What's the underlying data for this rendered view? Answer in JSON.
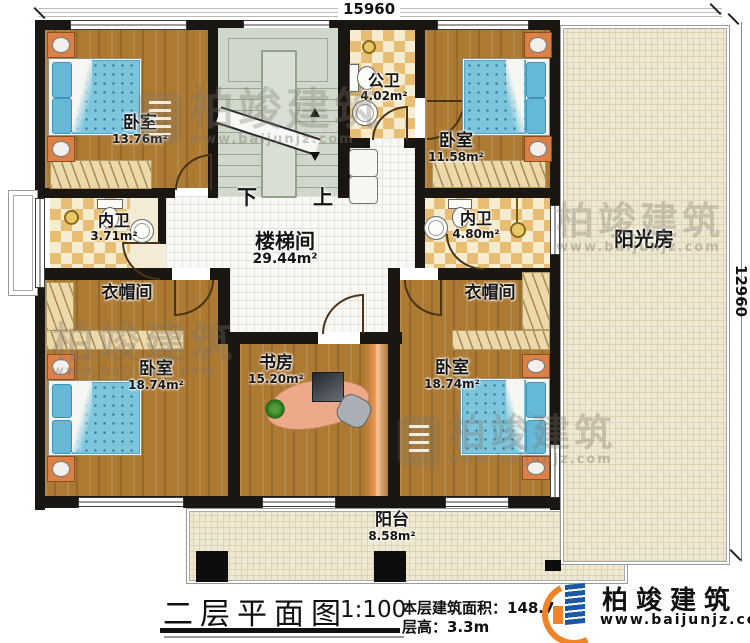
{
  "dimensions": {
    "top": "15960",
    "right": "12960"
  },
  "stairs": {
    "down_label": "下",
    "up_label": "上"
  },
  "rooms": {
    "bedroom_tl": {
      "name": "卧室",
      "area": "13.76m²"
    },
    "public_bath": {
      "name": "公卫",
      "area": "4.02m²"
    },
    "bedroom_tr": {
      "name": "卧室",
      "area": "11.58m²"
    },
    "bath_left": {
      "name": "内卫",
      "area": "3.71m²"
    },
    "stair_hall": {
      "name": "楼梯间",
      "area": "29.44m²"
    },
    "bath_right": {
      "name": "内卫",
      "area": "4.80m²"
    },
    "sunroom": {
      "name": "阳光房",
      "area": ""
    },
    "cloak_left": {
      "name": "衣帽间",
      "area": ""
    },
    "cloak_right": {
      "name": "衣帽间",
      "area": ""
    },
    "bedroom_bl": {
      "name": "卧室",
      "area": "18.74m²"
    },
    "study": {
      "name": "书房",
      "area": "15.20m²"
    },
    "bedroom_br": {
      "name": "卧室",
      "area": "18.74m²"
    },
    "balcony": {
      "name": "阳台",
      "area": "8.58m²"
    }
  },
  "title_block": {
    "title": "二层平面图",
    "scale": "1:100",
    "area_text": "本层建筑面积：148.7",
    "height_text": "层高：3.3m"
  },
  "logo": {
    "name": "柏竣建筑",
    "url": "www.baijunjz.com"
  },
  "watermark": {
    "text": "柏竣建筑",
    "url": "www.baijunjz.com"
  },
  "colors": {
    "wall": "#1a1611",
    "wood_floor": "#ad7a33",
    "tile_checker": "#e8be74",
    "bed_blue": "#7cc5dc",
    "stair_green": "#cfd8ca",
    "sunroom_cream": "#efe8d2",
    "logo_blue": "#1c57a5",
    "logo_orange": "#f08326"
  }
}
